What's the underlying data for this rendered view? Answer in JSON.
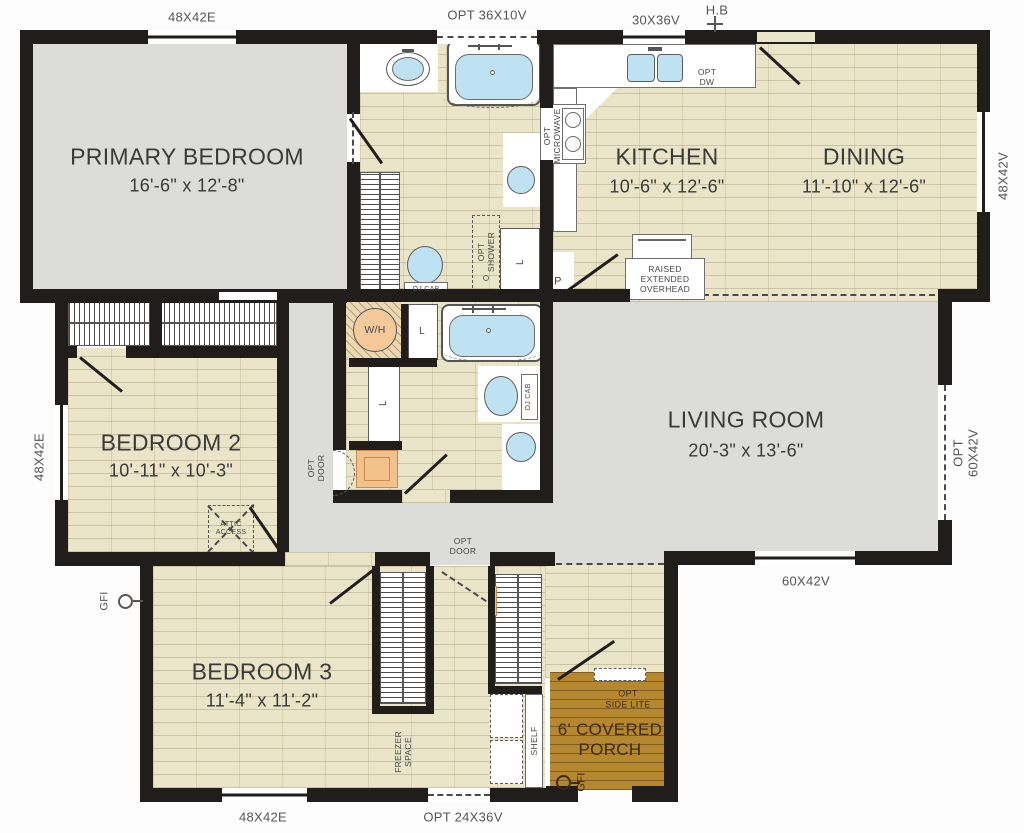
{
  "rooms": {
    "primary": {
      "name": "PRIMARY BEDROOM",
      "dims": "16'-6\" x 12'-8\""
    },
    "kitchen": {
      "name": "KITCHEN",
      "dims": "10'-6\" x 12'-6\""
    },
    "dining": {
      "name": "DINING",
      "dims": "11'-10\" x 12'-6\""
    },
    "living": {
      "name": "LIVING ROOM",
      "dims": "20'-3\" x 13'-6\""
    },
    "bed2": {
      "name": "BEDROOM 2",
      "dims": "10'-11\" x 10'-3\""
    },
    "bed3": {
      "name": "BEDROOM 3",
      "dims": "11'-4\" x 11'-2\""
    },
    "porch": {
      "name": "6' COVERED\nPORCH"
    }
  },
  "windows": {
    "top_left": "48X42E",
    "tub": "OPT 36X10V",
    "kitchen": "30X36V",
    "dining_right": "48X42V",
    "living_right": "OPT 60X42V",
    "living_bottom": "60X42V",
    "bed2_left": "48X42E",
    "bed3_bottom": "48X42E",
    "utility_bottom": "OPT 24X36V"
  },
  "fixtures": {
    "hose_bib": "H.B",
    "gfi_left": "GFI",
    "gfi_porch": "GFI",
    "water_heater": "W/H",
    "opt_dw": "OPT\nDW",
    "opt_microwave": "OPT\nMICROWAVE",
    "raised_overhead": "RAISED\nEXTENDED\nOVERHEAD",
    "pantry": "P",
    "oj_cab_primary": "OJ CAB",
    "oj_cab_hall": "OJ CAB",
    "opt_shower": "OPT\nSHOWER",
    "linen_primary": "L",
    "linen_hall_upper": "L",
    "linen_hall_lower": "L",
    "attic_access": "ATTIC\nACCESS",
    "opt_door_hall": "OPT\nDOOR",
    "opt_door_rear": "OPT\nDOOR",
    "freezer_space": "FREEZER\nSPACE",
    "shelf": "SHELF",
    "opt_side_lite": "OPT\nSIDE LITE"
  },
  "colors": {
    "wall": "#211d1a",
    "hard_floor": "#dcdcda",
    "wood_floor": "#eae4c9",
    "porch": "#b5872f",
    "water": "#bfe2f2",
    "appliance_orange": "#f3c18c"
  }
}
